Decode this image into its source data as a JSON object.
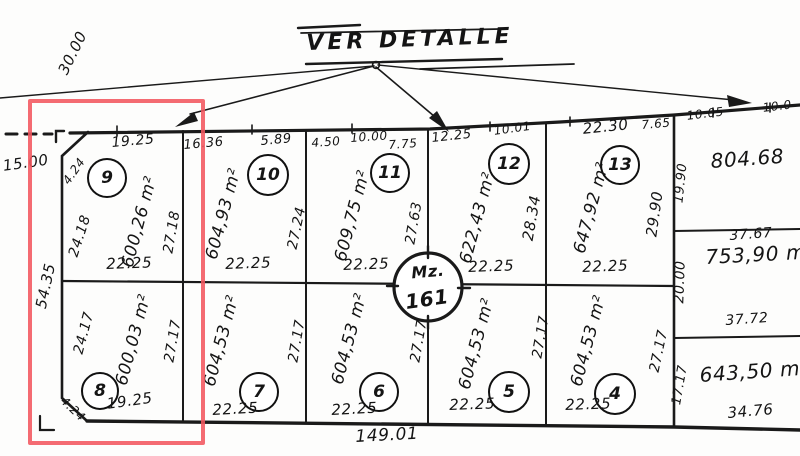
{
  "annotation": {
    "ver_detalle": "VER DETALLE"
  },
  "outside": {
    "street_width": "30.00",
    "left_dim": "15.00",
    "left_side": "54.35",
    "bottom_total": "149.01"
  },
  "block": {
    "label": "Mz.",
    "number": "161"
  },
  "top_lots": [
    {
      "num": "9",
      "area": "600,26 m²",
      "top1": "19.25",
      "left": "24.18",
      "right": "27.18",
      "bottom": "22.25",
      "chamfer": "4.24"
    },
    {
      "num": "10",
      "area": "604,93 m²",
      "top1": "16.36",
      "top2": "5.89",
      "right": "27.24",
      "bottom": "22.25"
    },
    {
      "num": "11",
      "area": "609,75 m²",
      "top1": "4.50",
      "top2": "10.00",
      "top3": "7.75",
      "right": "27.63",
      "bottom": "22.25"
    },
    {
      "num": "12",
      "area": "622,43 m²",
      "top1": "12.25",
      "top2": "10.01",
      "right": "28.34",
      "bottom": "22.25"
    },
    {
      "num": "13",
      "area": "647,92 m²",
      "top1": "22.30",
      "right": "29.90",
      "bottom": "22.25"
    }
  ],
  "bottom_lots": [
    {
      "num": "8",
      "area": "600,03 m²",
      "left": "24.17",
      "right": "27.17",
      "bottom": "19.25",
      "chamfer": "4.24"
    },
    {
      "num": "7",
      "area": "604,53 m²",
      "right": "27.17",
      "bottom": "22.25"
    },
    {
      "num": "6",
      "area": "604,53 m²",
      "right": "27.17",
      "bottom": "22.25"
    },
    {
      "num": "5",
      "area": "604,53 m²",
      "right": "27.17",
      "bottom": "22.25"
    },
    {
      "num": "4",
      "area": "604,53 m²",
      "right": "27.17",
      "bottom": "22.25"
    }
  ],
  "right_lots": [
    {
      "area": "804.68",
      "top1": "7.65",
      "top2": "10.05",
      "top3": "10.0",
      "left": "19.90"
    },
    {
      "area": "753,90 m²",
      "top_dim": "37.67",
      "bottom_dim": "37.72",
      "left": "20.00"
    },
    {
      "area": "643,50 m²",
      "left": "17.17",
      "bottom_dim": "34.76"
    }
  ],
  "highlight": {
    "color": "#f2565f"
  }
}
